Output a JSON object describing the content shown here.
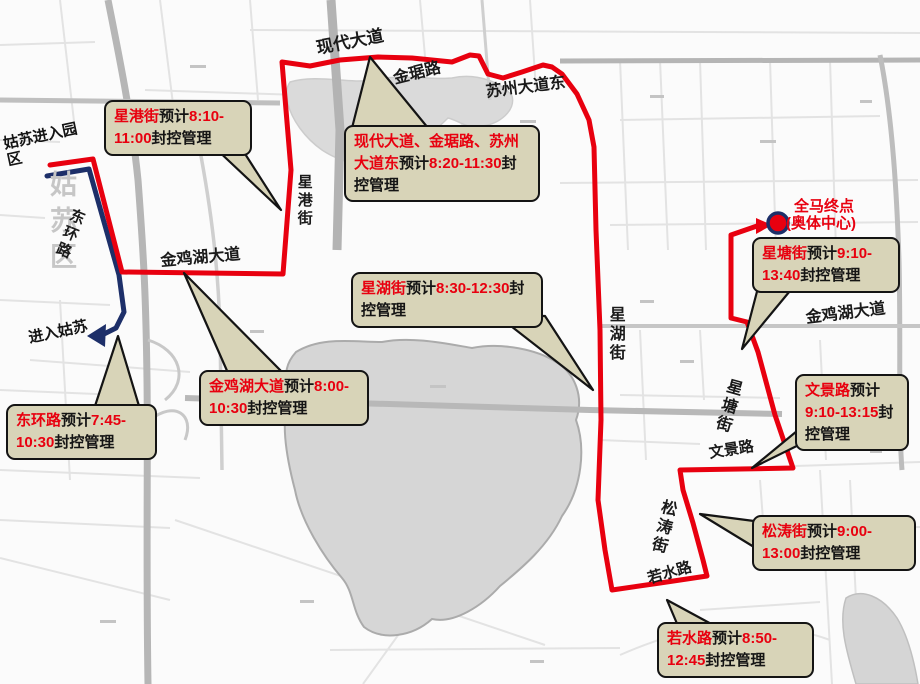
{
  "map": {
    "watermark": "姑苏区",
    "start_note": "姑苏进入园区",
    "entry_note": "进入姑苏",
    "roads": {
      "xiandai": "现代大道",
      "jinju": "金琚路",
      "suzhou_ave_e": "苏州大道东",
      "xinggang": "星港街",
      "donghuan": "东环路",
      "jinjihu_w": "金鸡湖大道",
      "xinghu": "星湖街",
      "xingtang": "星塘街",
      "jinjihu_e": "金鸡湖大道",
      "wenjing": "文景路",
      "songtao": "松涛街",
      "ruoshui": "若水路"
    },
    "finish": {
      "line1": "全马终点",
      "line2": "(奥体中心)"
    }
  },
  "callouts": [
    {
      "road": "星港街",
      "estimate": "预计",
      "time": "8:10-11:00",
      "action": "封控管理"
    },
    {
      "road": "现代大道、金琚路、苏州大道东",
      "estimate": "预计",
      "time": "8:20-11:30",
      "action": "封控管理"
    },
    {
      "road": "星湖街",
      "estimate": "预计",
      "time": "8:30-12:30",
      "action": "封控管理"
    },
    {
      "road": "金鸡湖大道",
      "estimate": "预计",
      "time": "8:00-10:30",
      "action": "封控管理"
    },
    {
      "road": "东环路",
      "estimate": "预计",
      "time": "7:45-10:30",
      "action": "封控管理"
    },
    {
      "road": "星塘街",
      "estimate": "预计",
      "time": "9:10-13:40",
      "action": "封控管理"
    },
    {
      "road": "文景路",
      "estimate": "预计",
      "time": "9:10-13:15",
      "action": "封控管理"
    },
    {
      "road": "松涛街",
      "estimate": "预计",
      "time": "9:00-13:00",
      "action": "封控管理"
    },
    {
      "road": "若水路",
      "estimate": "预计",
      "time": "8:50-12:45",
      "action": "封控管理"
    }
  ],
  "colors": {
    "route": "#e8000f",
    "entry_line": "#1d2f69",
    "callout_bg": "#d8d4b8",
    "lake": "#d6d6d6"
  }
}
